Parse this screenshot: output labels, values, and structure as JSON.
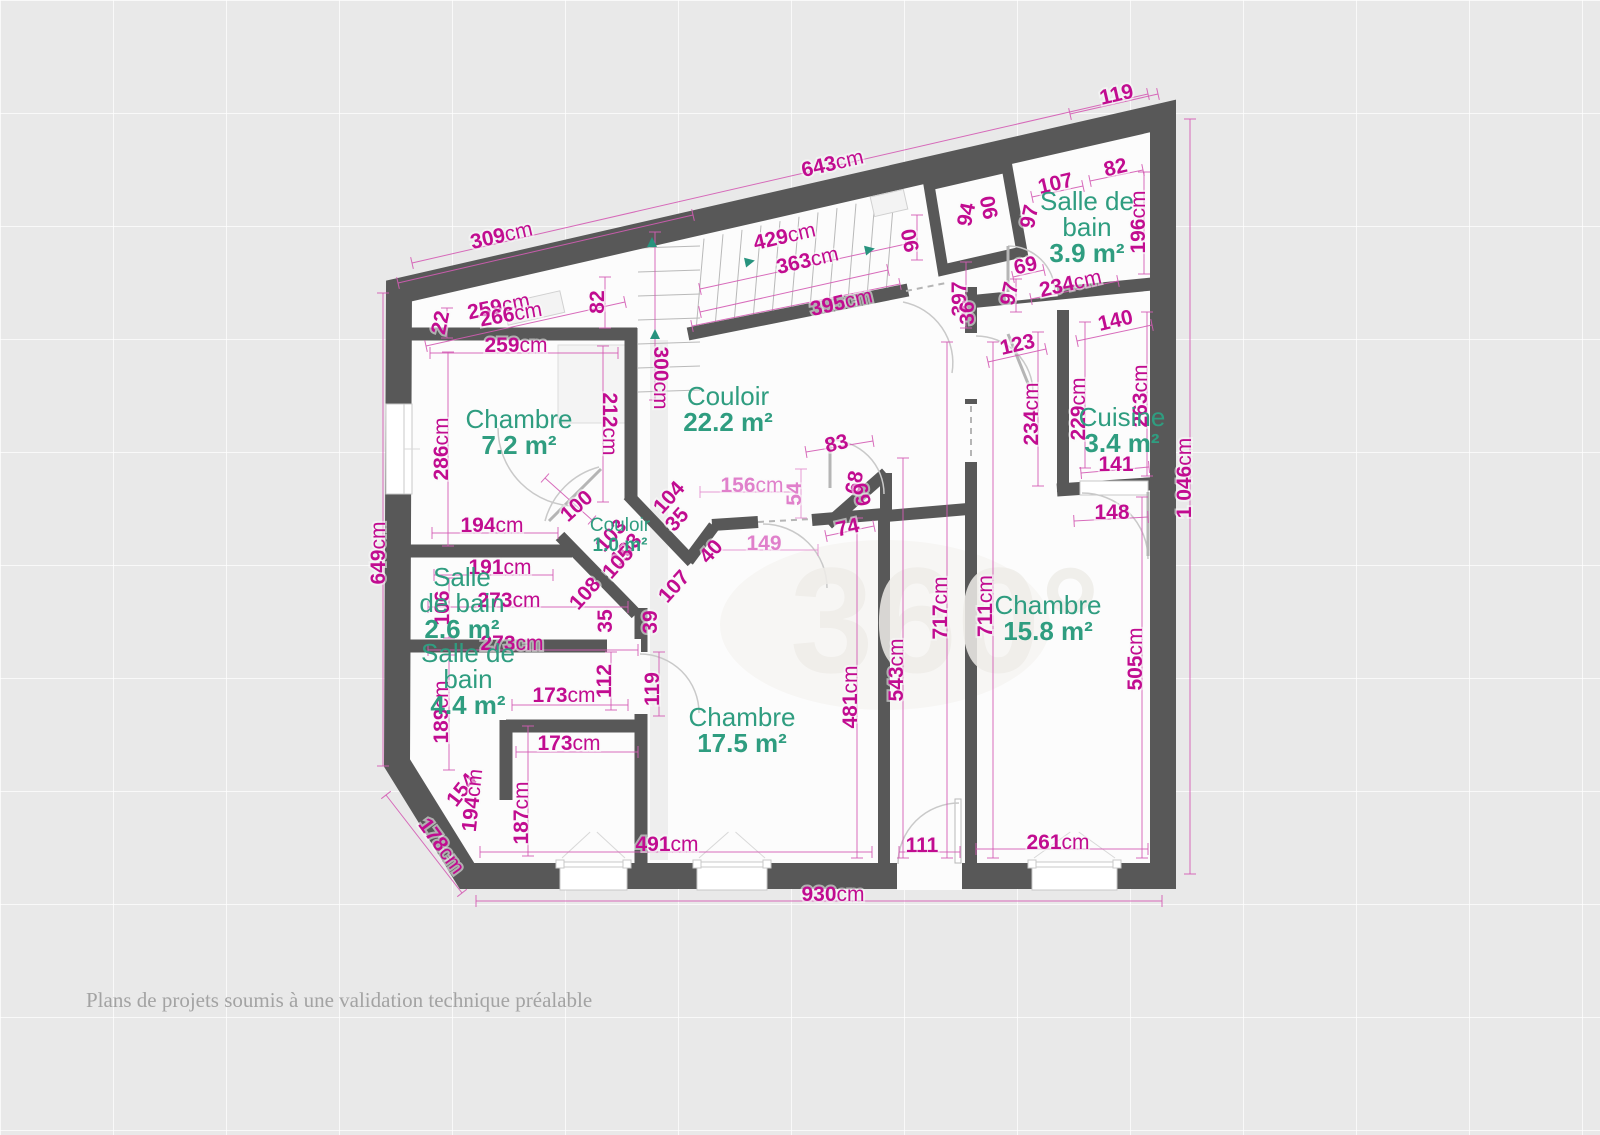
{
  "footer": "Plans de projets soumis à une validation technique préalable",
  "watermark": "360°",
  "colors": {
    "wall": "#585858",
    "dim_dark": "#c10c90",
    "dim_light": "#e080cb",
    "room_green": "#2f9d80",
    "stair_arrow": "#27937e",
    "floor": "#fcfcfc",
    "background": "#e9e9e9"
  },
  "plan": {
    "rooms": [
      {
        "lines": [
          "Chambre"
        ],
        "area": "7.2 m²",
        "x": 519,
        "y": 428
      },
      {
        "lines": [
          "Couloir"
        ],
        "area": "22.2 m²",
        "x": 728,
        "y": 405
      },
      {
        "lines": [
          "Salle de",
          "bain"
        ],
        "area": "3.9 m²",
        "x": 1087,
        "y": 210
      },
      {
        "lines": [
          "Cuisine"
        ],
        "area": "3.4 m²",
        "x": 1122,
        "y": 426
      },
      {
        "lines": [
          "Chambre"
        ],
        "area": "15.8 m²",
        "x": 1048,
        "y": 614
      },
      {
        "lines": [
          "Chambre"
        ],
        "area": "17.5 m²",
        "x": 742,
        "y": 726
      },
      {
        "lines": [
          "Salle",
          "de bain"
        ],
        "area": "2.6 m²",
        "x": 462,
        "y": 586
      },
      {
        "lines": [
          "Salle de",
          "bain"
        ],
        "area": "4.4 m²",
        "x": 468,
        "y": 662
      },
      {
        "lines": [
          "Couloir"
        ],
        "area": "1.0 m²",
        "x": 620,
        "y": 531,
        "small": true
      }
    ],
    "labels": [
      {
        "t": "119",
        "x": 1118,
        "y": 101,
        "r": -13
      },
      {
        "t": "643cm",
        "x": 834,
        "y": 170,
        "r": -13
      },
      {
        "t": "309cm",
        "x": 503,
        "y": 242,
        "r": -13
      },
      {
        "t": "429cm",
        "x": 786,
        "y": 243,
        "r": -13
      },
      {
        "t": "363cm",
        "x": 809,
        "y": 267,
        "r": -13
      },
      {
        "t": "395cm",
        "x": 843,
        "y": 309,
        "r": -13
      },
      {
        "t": "259cm",
        "x": 500,
        "y": 313,
        "r": -12
      },
      {
        "t": "266cm",
        "x": 512,
        "y": 321,
        "r": -10
      },
      {
        "t": "22",
        "x": 447,
        "y": 324,
        "r": -78
      },
      {
        "t": "82",
        "x": 604,
        "y": 302,
        "r": -90
      },
      {
        "t": "259cm",
        "x": 516,
        "y": 352,
        "r": 0
      },
      {
        "t": "300cm",
        "x": 654,
        "y": 378,
        "r": 90
      },
      {
        "t": "212cm",
        "x": 603,
        "y": 424,
        "r": 90
      },
      {
        "t": "90",
        "x": 917,
        "y": 239,
        "r": -102
      },
      {
        "t": "94",
        "x": 973,
        "y": 216,
        "r": -78
      },
      {
        "t": "90",
        "x": 996,
        "y": 206,
        "r": -102
      },
      {
        "t": "107",
        "x": 1057,
        "y": 190,
        "r": -13
      },
      {
        "t": "82",
        "x": 1117,
        "y": 174,
        "r": -13
      },
      {
        "t": "97",
        "x": 1036,
        "y": 218,
        "r": -78
      },
      {
        "t": "196cm",
        "x": 1145,
        "y": 222,
        "r": -90
      },
      {
        "t": "69",
        "x": 1027,
        "y": 272,
        "r": -13
      },
      {
        "t": "97",
        "x": 1016,
        "y": 295,
        "r": -78
      },
      {
        "t": "234cm",
        "x": 1072,
        "y": 290,
        "r": -13
      },
      {
        "t": "397",
        "x": 966,
        "y": 299,
        "r": -90
      },
      {
        "t": "36",
        "x": 974,
        "y": 313,
        "r": -90,
        "s": 26
      },
      {
        "t": "123",
        "x": 1019,
        "y": 351,
        "r": -13
      },
      {
        "t": "140",
        "x": 1117,
        "y": 327,
        "r": -13
      },
      {
        "t": "234cm",
        "x": 1038,
        "y": 414,
        "r": -90
      },
      {
        "t": "229cm",
        "x": 1085,
        "y": 409,
        "r": -90
      },
      {
        "t": "263cm",
        "x": 1147,
        "y": 396,
        "r": -90
      },
      {
        "t": "141",
        "x": 1116,
        "y": 471,
        "r": 0
      },
      {
        "t": "148",
        "x": 1112,
        "y": 519,
        "r": 0
      },
      {
        "t": "1 046cm",
        "x": 1191,
        "y": 478,
        "r": -90
      },
      {
        "t": "711cm",
        "x": 992,
        "y": 606,
        "r": -90
      },
      {
        "t": "505cm",
        "x": 1142,
        "y": 659,
        "r": -90
      },
      {
        "t": "717cm",
        "x": 947,
        "y": 608,
        "r": -90
      },
      {
        "t": "543cm",
        "x": 903,
        "y": 670,
        "r": -90
      },
      {
        "t": "481cm",
        "x": 857,
        "y": 697,
        "r": -90
      },
      {
        "t": "83",
        "x": 838,
        "y": 450,
        "r": -13
      },
      {
        "t": "54",
        "x": 801,
        "y": 494,
        "r": -90,
        "c": "light"
      },
      {
        "t": "68",
        "x": 861,
        "y": 484,
        "r": -78
      },
      {
        "t": "69",
        "x": 869,
        "y": 493,
        "r": -102
      },
      {
        "t": "156cm",
        "x": 752,
        "y": 492,
        "r": 0,
        "c": "light"
      },
      {
        "t": "74",
        "x": 849,
        "y": 534,
        "r": -13
      },
      {
        "t": "149",
        "x": 764,
        "y": 550,
        "r": 0,
        "c": "light"
      },
      {
        "t": "40",
        "x": 716,
        "y": 556,
        "r": -48
      },
      {
        "t": "100",
        "x": 581,
        "y": 511,
        "r": -42
      },
      {
        "t": "104",
        "x": 674,
        "y": 502,
        "r": -48
      },
      {
        "t": "35",
        "x": 682,
        "y": 524,
        "r": -48
      },
      {
        "t": "103",
        "x": 616,
        "y": 540,
        "r": -48
      },
      {
        "t": "103",
        "x": 631,
        "y": 554,
        "r": -48
      },
      {
        "t": "105",
        "x": 623,
        "y": 567,
        "r": -48
      },
      {
        "t": "108",
        "x": 590,
        "y": 598,
        "r": -48
      },
      {
        "t": "35",
        "x": 612,
        "y": 621,
        "r": -90
      },
      {
        "t": "107",
        "x": 679,
        "y": 591,
        "r": -48
      },
      {
        "t": "39",
        "x": 657,
        "y": 622,
        "r": -90
      },
      {
        "t": "286cm",
        "x": 448,
        "y": 449,
        "r": -90
      },
      {
        "t": "194cm",
        "x": 492,
        "y": 532,
        "r": 0
      },
      {
        "t": "191cm",
        "x": 500,
        "y": 574,
        "r": 0
      },
      {
        "t": "106",
        "x": 449,
        "y": 608,
        "r": -90
      },
      {
        "t": "273cm",
        "x": 509,
        "y": 607,
        "r": 0
      },
      {
        "t": "273cm",
        "x": 512,
        "y": 650,
        "r": 0
      },
      {
        "t": "189cm",
        "x": 448,
        "y": 712,
        "r": -90
      },
      {
        "t": "112",
        "x": 611,
        "y": 681,
        "r": -90
      },
      {
        "t": "119",
        "x": 659,
        "y": 689,
        "r": -90
      },
      {
        "t": "173cm",
        "x": 564,
        "y": 702,
        "r": 0
      },
      {
        "t": "173cm",
        "x": 569,
        "y": 750,
        "r": 0
      },
      {
        "t": "187cm",
        "x": 528,
        "y": 813,
        "r": -90
      },
      {
        "t": "154",
        "x": 467,
        "y": 794,
        "r": -52
      },
      {
        "t": "194cm",
        "x": 479,
        "y": 801,
        "r": -84
      },
      {
        "t": "178cm",
        "x": 436,
        "y": 850,
        "r": 54
      },
      {
        "t": "649cm",
        "x": 385,
        "y": 553,
        "r": -90
      },
      {
        "t": "491cm",
        "x": 667,
        "y": 851,
        "r": 0
      },
      {
        "t": "111",
        "x": 922,
        "y": 852,
        "r": 0
      },
      {
        "t": "261cm",
        "x": 1058,
        "y": 849,
        "r": 0
      },
      {
        "t": "930cm",
        "x": 833,
        "y": 901,
        "r": 0
      }
    ],
    "dimLines": [
      [
        412,
        263,
        1148,
        94
      ],
      [
        398,
        283,
        693,
        215
      ],
      [
        1070,
        114,
        1158,
        94
      ],
      [
        383,
        293,
        383,
        766
      ],
      [
        386,
        795,
        462,
        893
      ],
      [
        476,
        901,
        1162,
        901
      ],
      [
        1190,
        119,
        1190,
        874
      ],
      [
        426,
        346,
        625,
        302
      ],
      [
        430,
        353,
        618,
        353
      ],
      [
        700,
        289,
        906,
        244
      ],
      [
        700,
        312,
        888,
        270
      ],
      [
        692,
        326,
        900,
        284
      ],
      [
        605,
        277,
        605,
        328
      ],
      [
        447,
        308,
        447,
        338
      ],
      [
        448,
        352,
        448,
        546
      ],
      [
        603,
        346,
        603,
        502
      ],
      [
        655,
        232,
        655,
        400
      ],
      [
        432,
        533,
        558,
        533
      ],
      [
        434,
        575,
        553,
        575
      ],
      [
        428,
        607,
        628,
        607
      ],
      [
        428,
        650,
        638,
        650
      ],
      [
        449,
        578,
        449,
        638
      ],
      [
        700,
        492,
        798,
        492,
        1
      ],
      [
        712,
        550,
        818,
        550,
        1
      ],
      [
        826,
        536,
        874,
        526
      ],
      [
        806,
        452,
        873,
        441
      ],
      [
        801,
        469,
        801,
        518,
        1
      ],
      [
        857,
        518,
        857,
        858
      ],
      [
        903,
        458,
        903,
        858
      ],
      [
        947,
        342,
        947,
        858
      ],
      [
        993,
        342,
        993,
        858
      ],
      [
        1142,
        497,
        1142,
        858
      ],
      [
        1038,
        332,
        1038,
        486
      ],
      [
        1085,
        322,
        1085,
        468
      ],
      [
        1147,
        312,
        1147,
        476
      ],
      [
        1077,
        341,
        1152,
        325
      ],
      [
        988,
        362,
        1046,
        349
      ],
      [
        1081,
        473,
        1149,
        467
      ],
      [
        1074,
        521,
        1148,
        517
      ],
      [
        1144,
        172,
        1144,
        274
      ],
      [
        1032,
        197,
        1083,
        186
      ],
      [
        1090,
        181,
        1143,
        170
      ],
      [
        1013,
        277,
        1044,
        270
      ],
      [
        1016,
        279,
        1016,
        312
      ],
      [
        1031,
        299,
        1118,
        281
      ],
      [
        917,
        215,
        917,
        260
      ],
      [
        966,
        262,
        966,
        328
      ],
      [
        449,
        655,
        449,
        770
      ],
      [
        512,
        705,
        628,
        705
      ],
      [
        516,
        752,
        638,
        752
      ],
      [
        611,
        652,
        611,
        710
      ],
      [
        659,
        652,
        659,
        716
      ],
      [
        528,
        726,
        528,
        856
      ],
      [
        480,
        852,
        872,
        852
      ],
      [
        899,
        852,
        960,
        852
      ],
      [
        976,
        849,
        1148,
        849
      ],
      [
        545,
        478,
        592,
        520
      ]
    ],
    "windows": {
      "bottom": [
        {
          "x": 560,
          "y": 862,
          "w": 67
        },
        {
          "x": 697,
          "y": 862,
          "w": 70
        },
        {
          "x": 1032,
          "y": 862,
          "w": 85
        }
      ],
      "left": {
        "x": 386,
        "y": 404,
        "w": 26,
        "h": 90
      },
      "slope": [
        {
          "x": 505,
          "y": 297,
          "w": 58,
          "h": 22,
          "r": -12.9
        },
        {
          "x": 872,
          "y": 193,
          "w": 34,
          "h": 20,
          "r": -12.9
        }
      ],
      "cuisine_sill": {
        "x": 1080,
        "y": 481,
        "w": 68,
        "h": 14
      }
    },
    "arrows": [
      {
        "x": 652,
        "y": 244,
        "r": 0
      },
      {
        "x": 655,
        "y": 336,
        "r": 0
      },
      {
        "x": 748,
        "y": 262,
        "r": 78
      },
      {
        "x": 868,
        "y": 250,
        "r": 78
      }
    ]
  }
}
